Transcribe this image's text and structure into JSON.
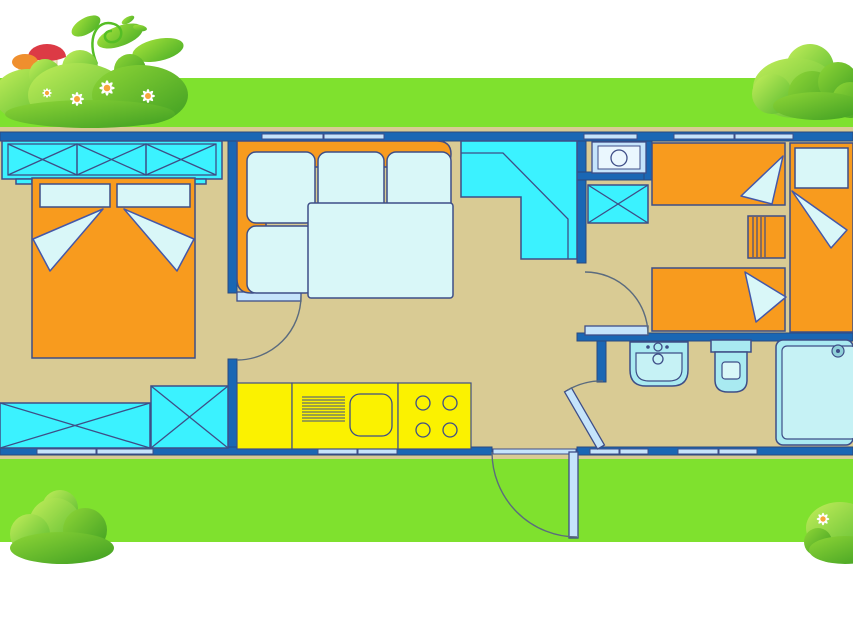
{
  "meta": {
    "title": "Mobile home floor plan illustration",
    "canvas_width": 853,
    "canvas_height": 619
  },
  "palette": {
    "background": "#FFFFFF",
    "grass": "#7FE12E",
    "floor": "#D9CB94",
    "wall": "#1A67B4",
    "outline": "#3E4E87",
    "arc": "#5B6B7E",
    "furniture-orange": "#F89B1E",
    "bright-cyan": "#3BF2FF",
    "pale-cyan": "#D9F7F8",
    "fixture-cyan": "#A9EAF1",
    "fixture-inner": "#C6F2F5",
    "window-blue": "#C5E4FB",
    "boiler-inner": "#EAF7FE",
    "kitchen-yellow": "#FBF200",
    "bush-light": "#C3EE5B",
    "bush-dark": "#55B92E",
    "bush-mid": "#8FD637",
    "bush-deep": "#3E9E22",
    "mushroom-red": "#DC3A45",
    "mushroom-orange": "#EF8F2E",
    "mushroom-stem": "#F1E6C8",
    "daisy-white": "#FFFFFF",
    "daisy-center": "#F5A63B"
  },
  "scene": {
    "decorations": [
      "grass-strip-top",
      "grass-strip-bottom",
      "bush-with-mushrooms-and-daisies-top-left",
      "bush-top-right",
      "bush-bottom-left",
      "bush-with-daisy-bottom-right"
    ],
    "rooms": [
      {
        "name": "bedroom-1",
        "furniture": [
          "triple-wardrobe-x-doors",
          "double-bed",
          "pillow",
          "pillow",
          "blanket-fold",
          "blanket-fold",
          "long-storage-chest-x",
          "square-storage-chest-x"
        ],
        "doors": [
          "door-to-living-room"
        ]
      },
      {
        "name": "living-room",
        "furniture": [
          "corner-sofa-orange-back",
          "seat-cushion",
          "seat-cushion",
          "seat-cushion",
          "seat-cushion",
          "coffee-table",
          "corner-bench-unit"
        ]
      },
      {
        "name": "kitchen",
        "furniture": [
          "counter-section",
          "sink-with-drainboard",
          "four-burner-stove"
        ]
      },
      {
        "name": "hallway",
        "furniture": [
          "boiler-unit",
          "storage-cabinet-x"
        ],
        "doors": [
          "entrance-door",
          "door-to-bedroom-2",
          "door-to-bathroom"
        ]
      },
      {
        "name": "bedroom-2",
        "furniture": [
          "single-bed-top",
          "single-bed-bottom",
          "single-bed-vertical-with-pillow",
          "slatted-nightstand",
          "blanket-fold",
          "blanket-fold",
          "blanket-fold"
        ]
      },
      {
        "name": "bathroom",
        "furniture": [
          "washbasin",
          "toilet",
          "shower-cabin-with-drain"
        ]
      }
    ],
    "window_count": {
      "top_wall": 5,
      "bottom_wall": 8
    }
  }
}
